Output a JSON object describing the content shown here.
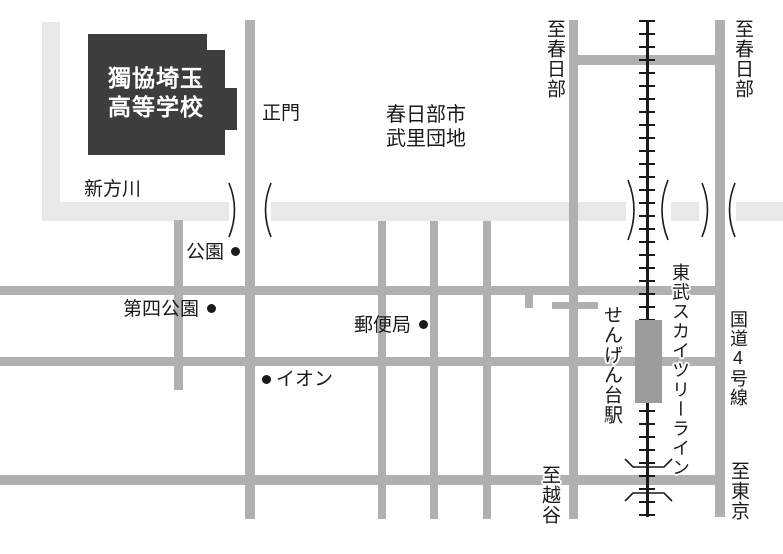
{
  "map": {
    "school": {
      "line1": "獨協埼玉",
      "line2": "高等学校"
    },
    "labels": {
      "main_gate": "正門",
      "river": "新方川",
      "district_line1": "春日部市",
      "district_line2": "武里団地",
      "park": "公園",
      "fourth_park": "第四公園",
      "post_office": "郵便局",
      "aeon": "イオン",
      "to_kasukabe_west": "至春日部",
      "to_kasukabe_east": "至春日部",
      "to_koshigaya": "至越谷",
      "to_tokyo": "至東京",
      "station": "せんげん台駅",
      "rail_line": "東武スカイツリーライン",
      "route4": "国道4号線"
    },
    "colors": {
      "road": "#b0b0b0",
      "river": "#e8e8e8",
      "school": "#3d3d3d",
      "station": "#9c9c9c",
      "ink": "#1a1a1a"
    }
  }
}
